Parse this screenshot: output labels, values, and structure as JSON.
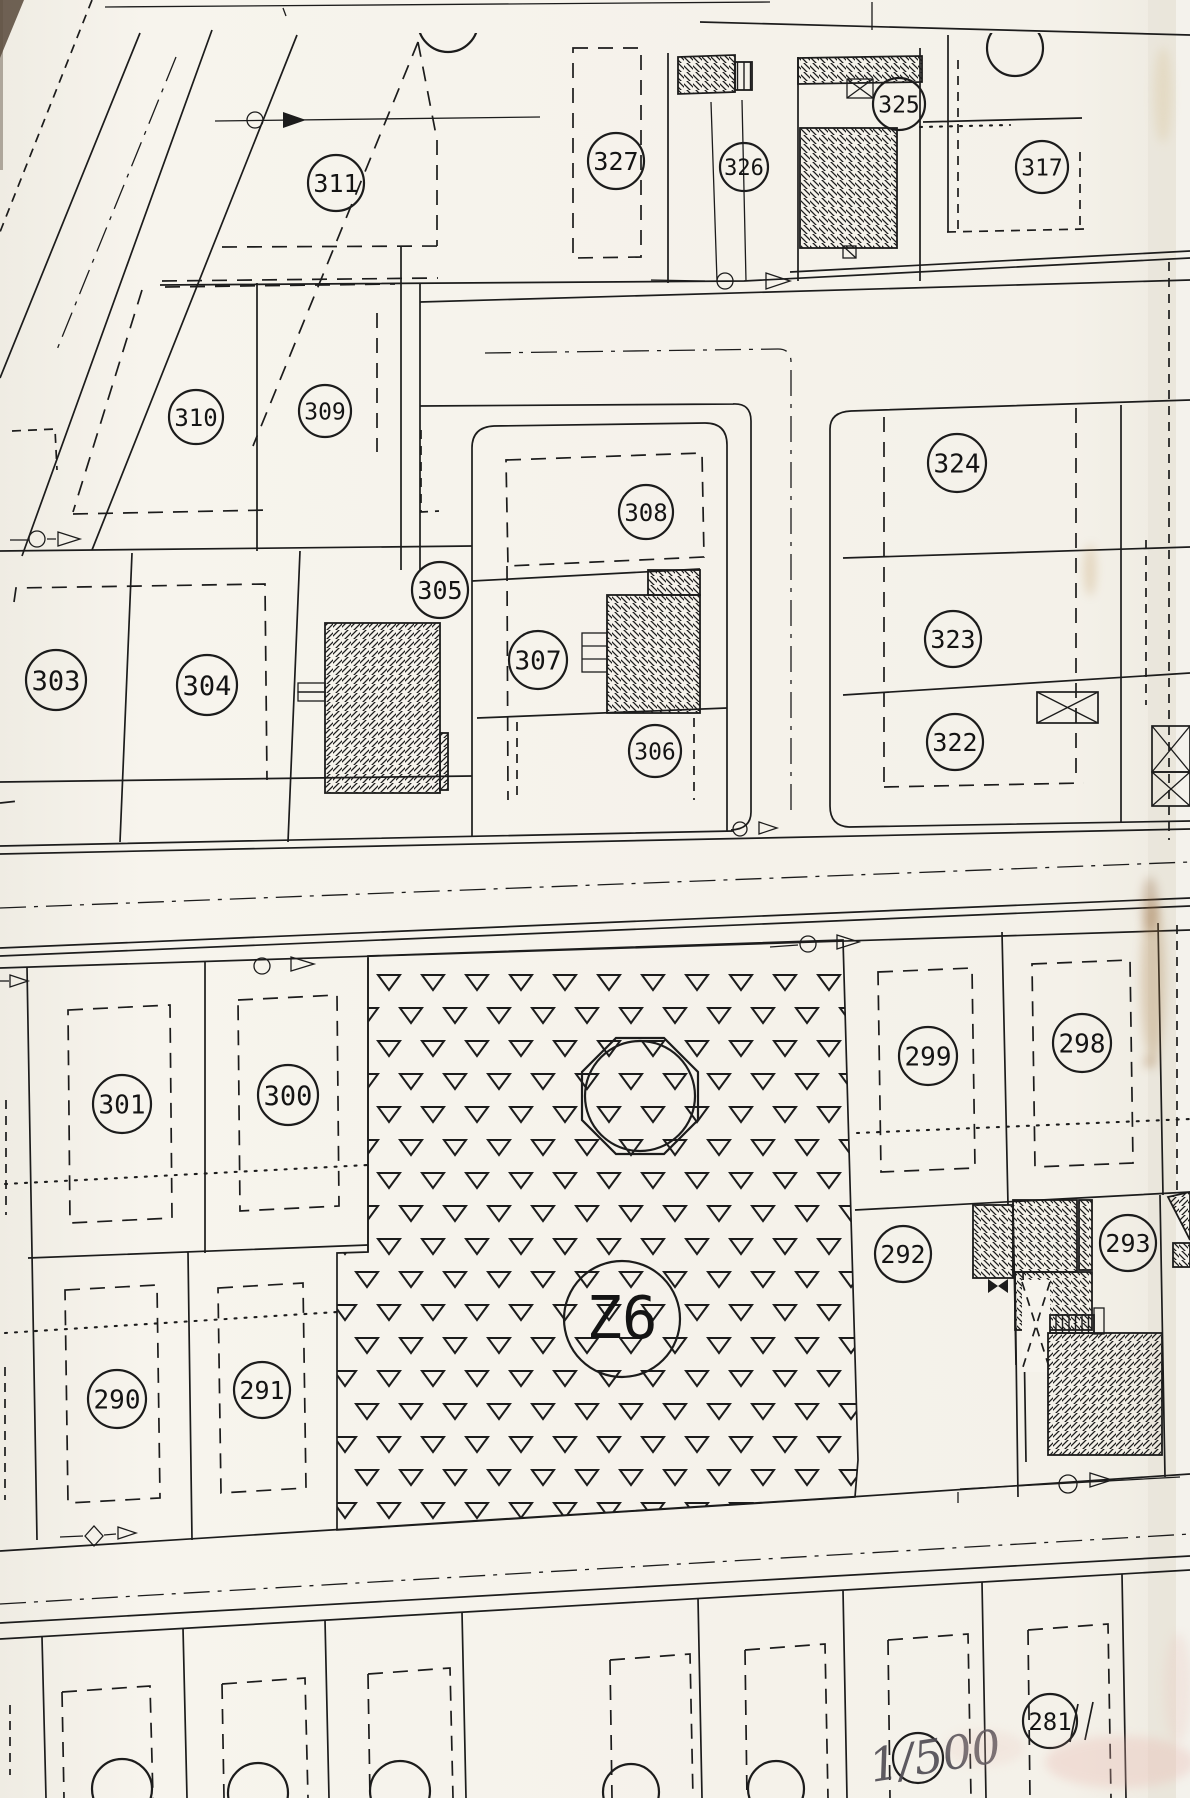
{
  "document": {
    "type": "scanned cadastral parcel plan",
    "scale_note": "1/500"
  },
  "map": {
    "zone_label": {
      "text": "Z6",
      "x": 622,
      "y": 1319,
      "r": 58
    },
    "parcels": [
      {
        "label": "311",
        "x": 336,
        "y": 183,
        "r": 28
      },
      {
        "label": "327",
        "x": 616,
        "y": 161,
        "r": 28
      },
      {
        "label": "326",
        "x": 744,
        "y": 167,
        "r": 24
      },
      {
        "label": "325",
        "x": 899,
        "y": 104,
        "r": 26
      },
      {
        "label": "317",
        "x": 1042,
        "y": 167,
        "r": 26
      },
      {
        "label": "310",
        "x": 196,
        "y": 417,
        "r": 27
      },
      {
        "label": "309",
        "x": 325,
        "y": 411,
        "r": 26
      },
      {
        "label": "308",
        "x": 646,
        "y": 512,
        "r": 27
      },
      {
        "label": "305",
        "x": 440,
        "y": 590,
        "r": 28
      },
      {
        "label": "307",
        "x": 538,
        "y": 660,
        "r": 29
      },
      {
        "label": "306",
        "x": 655,
        "y": 751,
        "r": 26
      },
      {
        "label": "303",
        "x": 56,
        "y": 680,
        "r": 30
      },
      {
        "label": "304",
        "x": 207,
        "y": 685,
        "r": 30
      },
      {
        "label": "324",
        "x": 957,
        "y": 463,
        "r": 29
      },
      {
        "label": "323",
        "x": 953,
        "y": 639,
        "r": 28
      },
      {
        "label": "322",
        "x": 955,
        "y": 742,
        "r": 28
      },
      {
        "label": "301",
        "x": 122,
        "y": 1104,
        "r": 29
      },
      {
        "label": "300",
        "x": 288,
        "y": 1095,
        "r": 30
      },
      {
        "label": "299",
        "x": 928,
        "y": 1056,
        "r": 29
      },
      {
        "label": "298",
        "x": 1082,
        "y": 1043,
        "r": 29
      },
      {
        "label": "292",
        "x": 903,
        "y": 1254,
        "r": 28
      },
      {
        "label": "293",
        "x": 1128,
        "y": 1243,
        "r": 28
      },
      {
        "label": "290",
        "x": 117,
        "y": 1399,
        "r": 29
      },
      {
        "label": "291",
        "x": 262,
        "y": 1390,
        "r": 28
      },
      {
        "label": "281",
        "x": 1050,
        "y": 1721,
        "r": 27
      }
    ],
    "partial_circles": [
      {
        "x": 448,
        "y": 22,
        "r": 30,
        "clip": "top"
      },
      {
        "x": 1015,
        "y": 48,
        "r": 28,
        "clip": "top"
      },
      {
        "x": 122,
        "y": 1789,
        "r": 30
      },
      {
        "x": 258,
        "y": 1793,
        "r": 30
      },
      {
        "x": 400,
        "y": 1791,
        "r": 30
      },
      {
        "x": 631,
        "y": 1792,
        "r": 28
      },
      {
        "x": 776,
        "y": 1789,
        "r": 28
      },
      {
        "x": 918,
        "y": 1758,
        "r": 25
      }
    ],
    "park": {
      "fill_pattern": "open-triangle grid",
      "landmark": "octagon with inscribed circle"
    },
    "symbols": {
      "survey_marker": "circle-with-arrow",
      "control_point": "diamond-with-arrow",
      "crossed_box": "rectangle-with-X",
      "building_fill": "diagonal hatch"
    },
    "colors": {
      "ink": "#1c1c1c",
      "paper": "#f6f3ec",
      "rust_stain": "#a97e46",
      "pink_smudge": "#e7b2aa",
      "pencil": "#4d4a52"
    }
  }
}
